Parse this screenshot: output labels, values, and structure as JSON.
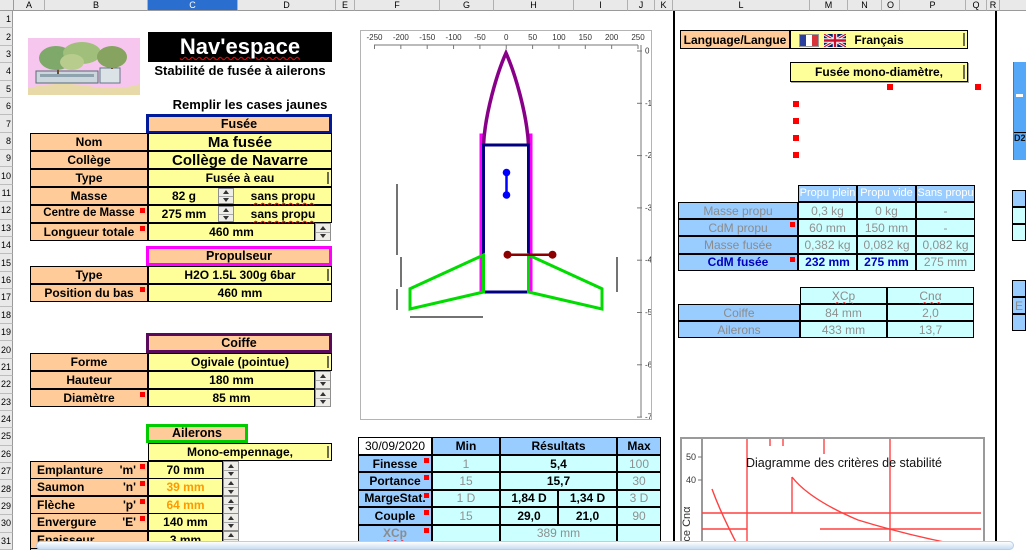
{
  "chrome": {
    "columns": [
      "A",
      "B",
      "C",
      "D",
      "E",
      "F",
      "G",
      "H",
      "I",
      "J",
      "K",
      "L",
      "M",
      "N",
      "O",
      "P",
      "Q",
      "R"
    ],
    "selected_column": "C",
    "row_count": 31
  },
  "header": {
    "title": "Nav'espace",
    "subtitle": "Stabilité de fusée à ailerons",
    "instruction": "Remplir les cases jaunes"
  },
  "fusee": {
    "title": "Fusée",
    "nom_label": "Nom",
    "nom": "Ma fusée",
    "college_label": "Collège",
    "college": "Collège de Navarre",
    "type_label": "Type",
    "type": "Fusée à eau",
    "masse_label": "Masse",
    "masse": "82 g",
    "masse_suffix": "sans propu",
    "cdm_label": "Centre de Masse",
    "cdm": "275 mm",
    "cdm_suffix": "sans propu",
    "longueur_label": "Longueur totale",
    "longueur": "460 mm"
  },
  "propulseur": {
    "title": "Propulseur",
    "type_label": "Type",
    "type": "H2O 1.5L 300g 6bar",
    "position_label": "Position du bas",
    "position": "460 mm"
  },
  "coiffe": {
    "title": "Coiffe",
    "forme_label": "Forme",
    "forme": "Ogivale (pointue)",
    "hauteur_label": "Hauteur",
    "hauteur": "180 mm",
    "diametre_label": "Diamètre",
    "diametre": "85 mm"
  },
  "ailerons": {
    "title": "Ailerons",
    "subtype": "Mono-empennage,",
    "rows": [
      {
        "label": "Emplanture",
        "letter": "'m'",
        "value": "70 mm",
        "orange": false,
        "comment": true
      },
      {
        "label": "Saumon",
        "letter": "'n'",
        "value": "39 mm",
        "orange": true,
        "comment": true
      },
      {
        "label": "Flèche",
        "letter": "'p'",
        "value": "64 mm",
        "orange": true,
        "comment": true
      },
      {
        "label": "Envergure",
        "letter": "'E'",
        "value": "140 mm",
        "orange": false,
        "comment": true
      },
      {
        "label": "Epaisseur",
        "letter": "",
        "value": "3 mm",
        "orange": false,
        "comment": false
      },
      {
        "label": "Nombre",
        "letter": "",
        "value": "4",
        "orange": false,
        "comment": false
      }
    ]
  },
  "language": {
    "label": "Language/Langue",
    "value": "Français"
  },
  "mono_diametre": "Fusée mono-diamètre,",
  "masses_table": {
    "col_headers": [
      "Propu plein",
      "Propu vide",
      "Sans propu"
    ],
    "rows": [
      {
        "label": "Masse propu",
        "values": [
          "0,3 kg",
          "0 kg",
          "-"
        ],
        "comment": false,
        "highlight": false
      },
      {
        "label": "CdM propu",
        "values": [
          "60 mm",
          "150 mm",
          "-"
        ],
        "comment": true,
        "highlight": false
      },
      {
        "label": "Masse fusée",
        "values": [
          "0,382 kg",
          "0,082 kg",
          "0,082 kg"
        ],
        "comment": false,
        "highlight": false
      },
      {
        "label": "CdM fusée",
        "values": [
          "232 mm",
          "275 mm",
          "275 mm"
        ],
        "comment": true,
        "highlight": true
      }
    ]
  },
  "cp_table": {
    "col_headers": [
      "XCp",
      "Cnα"
    ],
    "rows": [
      {
        "label": "Coiffe",
        "values": [
          "84 mm",
          "2,0"
        ]
      },
      {
        "label": "Ailerons",
        "values": [
          "433 mm",
          "13,7"
        ]
      }
    ]
  },
  "results": {
    "date": "30/09/2020",
    "headers": {
      "min": "Min",
      "res": "Résultats",
      "max": "Max"
    },
    "rows": [
      {
        "label": "Finesse",
        "min": "1",
        "res": [
          "5,4"
        ],
        "max": "100",
        "muted": false
      },
      {
        "label": "Portance",
        "min": "15",
        "res": [
          "15,7"
        ],
        "max": "30",
        "muted": false
      },
      {
        "label": "MargeStat.",
        "min": "1 D",
        "res": [
          "1,84 D",
          "1,34 D"
        ],
        "max": "3 D",
        "muted": false
      },
      {
        "label": "Couple",
        "min": "15",
        "res": [
          "29,0",
          "21,0"
        ],
        "max": "90",
        "muted": false
      },
      {
        "label": "XCp",
        "min": "",
        "res": [
          "389 mm"
        ],
        "max": "",
        "muted": true
      },
      {
        "label": "MS",
        "min": "",
        "res": [
          "24% L",
          "25% L"
        ],
        "max": "",
        "muted": true
      }
    ]
  },
  "diagram": {
    "x_ticks": [
      "-250",
      "-200",
      "-150",
      "-100",
      "-50",
      "0",
      "50",
      "100",
      "150",
      "200",
      "250"
    ],
    "y_ticks": [
      "0",
      "-100",
      "-200",
      "-300",
      "-400",
      "-500",
      "-600",
      "-700"
    ]
  },
  "stability_chart": {
    "title": "Diagramme des critères de stabilité",
    "ylabel": "Portance Cnα",
    "y_ticks": [
      "50",
      "40"
    ]
  },
  "edge": {
    "formula": "D2",
    "letter": "E"
  }
}
